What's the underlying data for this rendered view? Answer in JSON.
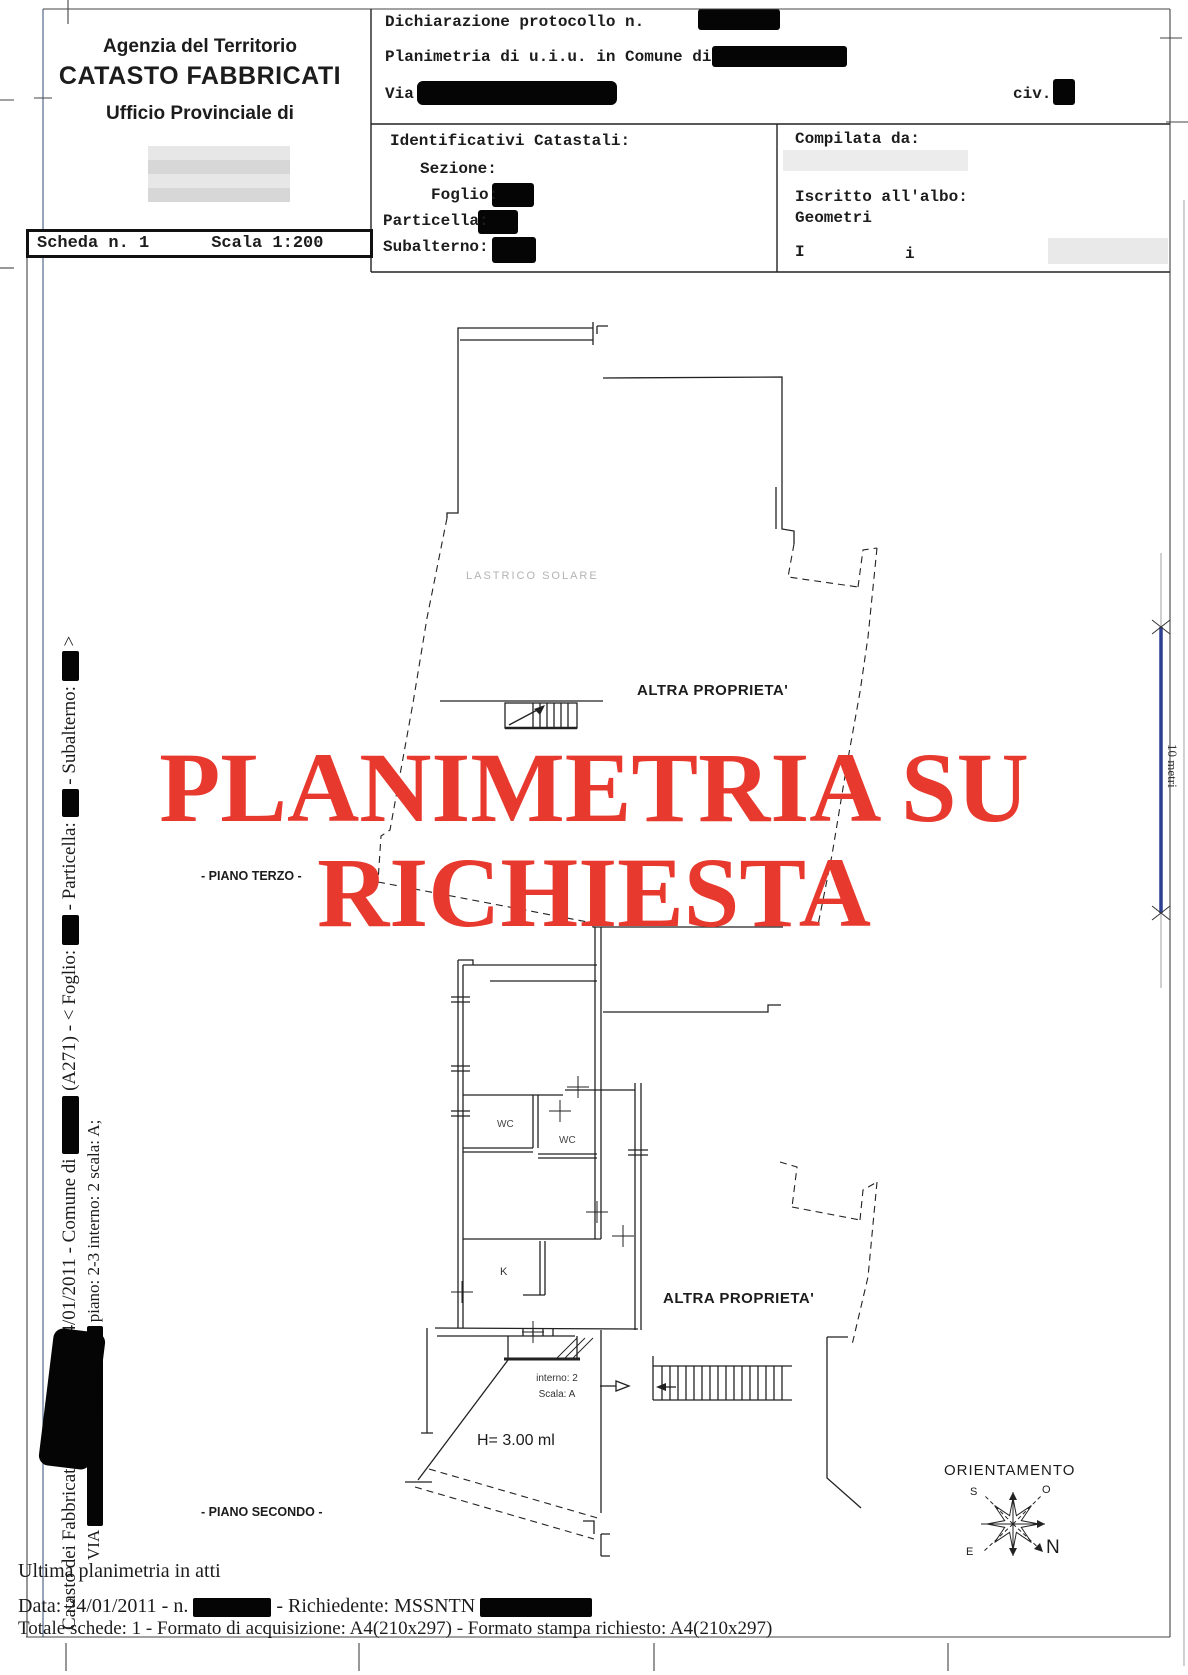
{
  "colors": {
    "watermark_red": "#e8392e",
    "scalebar_blue": "#2e3f92",
    "frame_blue": "#53688a",
    "ink": "#1c1c1c",
    "faint_gray": "#b3b3b3"
  },
  "header": {
    "agency_line1": "Agenzia del Territorio",
    "agency_line2": "CATASTO FABBRICATI",
    "agency_line3": "Ufficio Provinciale di",
    "scheda": "Scheda n. 1",
    "scala": "Scala 1:200",
    "dichiarazione": "Dichiarazione protocollo n.",
    "planimetria": "Planimetria di u.i.u. in Comune di",
    "via_label": "Via",
    "civ_label": "civ.",
    "identificativi": "Identificativi Catastali:",
    "sezione": "Sezione:",
    "foglio": "Foglio:",
    "particella": "Particella:",
    "subalterno": "Subalterno:",
    "compilata": "Compilata da:",
    "iscritto": "Iscritto all'albo:",
    "albo": "Geometri",
    "partial_left": "I",
    "partial_right": "i"
  },
  "plan": {
    "watermark_line1": "PLANIMETRIA SU",
    "watermark_line2": "RICHIESTA",
    "lastrico": "LASTRICO SOLARE",
    "altra_proprieta_top": "ALTRA PROPRIETA'",
    "altra_proprieta_bottom": "ALTRA PROPRIETA'",
    "piano_terzo": "- PIANO TERZO -",
    "piano_secondo": "- PIANO SECONDO -",
    "wc_1": "WC",
    "wc_2": "WC",
    "kitchen": "K",
    "interno": "interno: 2",
    "scala_int": "Scala: A",
    "height_note": "H= 3.00 ml",
    "orientamento": "ORIENTAMENTO",
    "compass_n": "N",
    "compass_s": "S",
    "compass_e": "E",
    "compass_o": "O",
    "scale_bar_label": "10 metri"
  },
  "sidebar": {
    "l1_a": "Catasto dei Fabbricati - Situazione al 24/01/2011 - Comune di",
    "l1_b": "(A271) - < Foglio:",
    "l1_c": "- Particella:",
    "l1_d": "- Subalterno:",
    "l1_e": ">",
    "l2_a": "VIA",
    "l2_b": "piano: 2-3 interno: 2 scala: A;"
  },
  "footer": {
    "ultima": "Ultima planimetria in atti",
    "data_a": "Data: 24/01/2011 - n.",
    "data_b": "- Richiedente: MSSNTN",
    "totale": "Totale schede: 1 - Formato di acquisizione: A4(210x297)  - Formato stampa richiesto: A4(210x297)"
  }
}
